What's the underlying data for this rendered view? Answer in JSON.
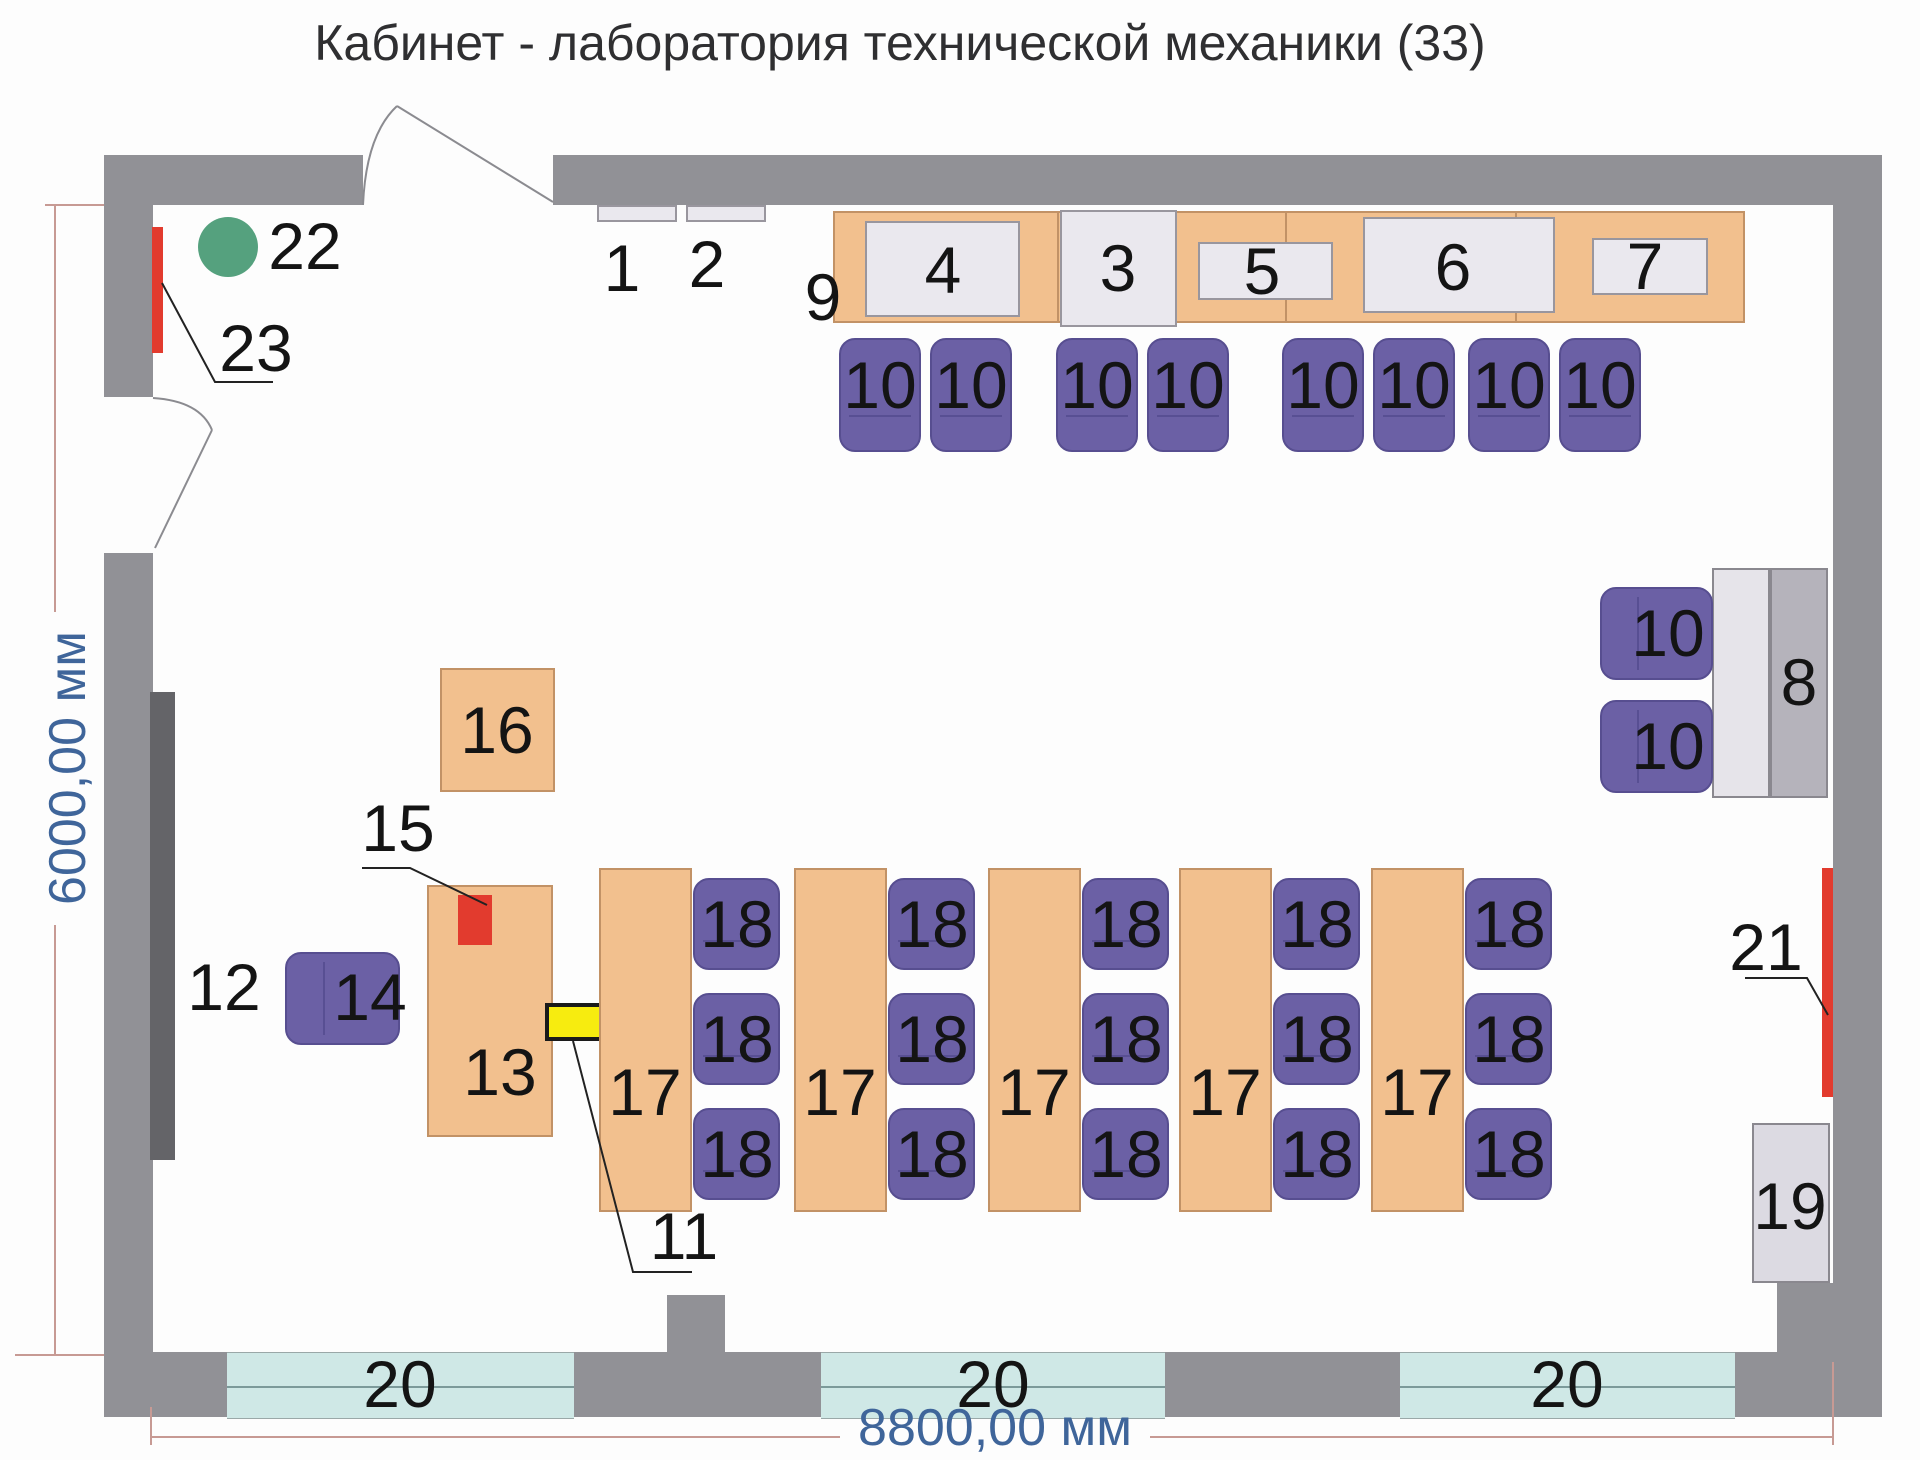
{
  "title": "Кабинет - лаборатория технической механики (33)",
  "dimensions": {
    "width_label": "8800,00 мм",
    "height_label": "6000,00 мм"
  },
  "colors": {
    "wall": "#919196",
    "furniture_tan": "#f2c08e",
    "chair_purple": "#6b60a5",
    "window_glass": "#cfe8e6",
    "accent_red": "#e23b2e",
    "accent_green": "#55a17e",
    "accent_yellow": "#f7ec0f",
    "dimension_text": "#3f659a",
    "dimension_line": "#c79a94"
  },
  "items": {
    "i1": "1",
    "i2": "2",
    "i3": "3",
    "i4": "4",
    "i5": "5",
    "i6": "6",
    "i7": "7",
    "i8": "8",
    "i9": "9",
    "i11": "11",
    "i12": "12",
    "i13": "13",
    "i14": "14",
    "i15": "15",
    "i16": "16",
    "i19": "19",
    "i21": "21",
    "i22": "22",
    "i23": "23"
  },
  "bench_row_chairs": [
    "10",
    "10",
    "10",
    "10",
    "10",
    "10",
    "10",
    "10"
  ],
  "side_chairs": [
    "10",
    "10"
  ],
  "desks": [
    {
      "label": "17",
      "chairs": [
        "18",
        "18",
        "18"
      ]
    },
    {
      "label": "17",
      "chairs": [
        "18",
        "18",
        "18"
      ]
    },
    {
      "label": "17",
      "chairs": [
        "18",
        "18",
        "18"
      ]
    },
    {
      "label": "17",
      "chairs": [
        "18",
        "18",
        "18"
      ]
    },
    {
      "label": "17",
      "chairs": [
        "18",
        "18",
        "18"
      ]
    }
  ],
  "windows": [
    "20",
    "20",
    "20"
  ]
}
